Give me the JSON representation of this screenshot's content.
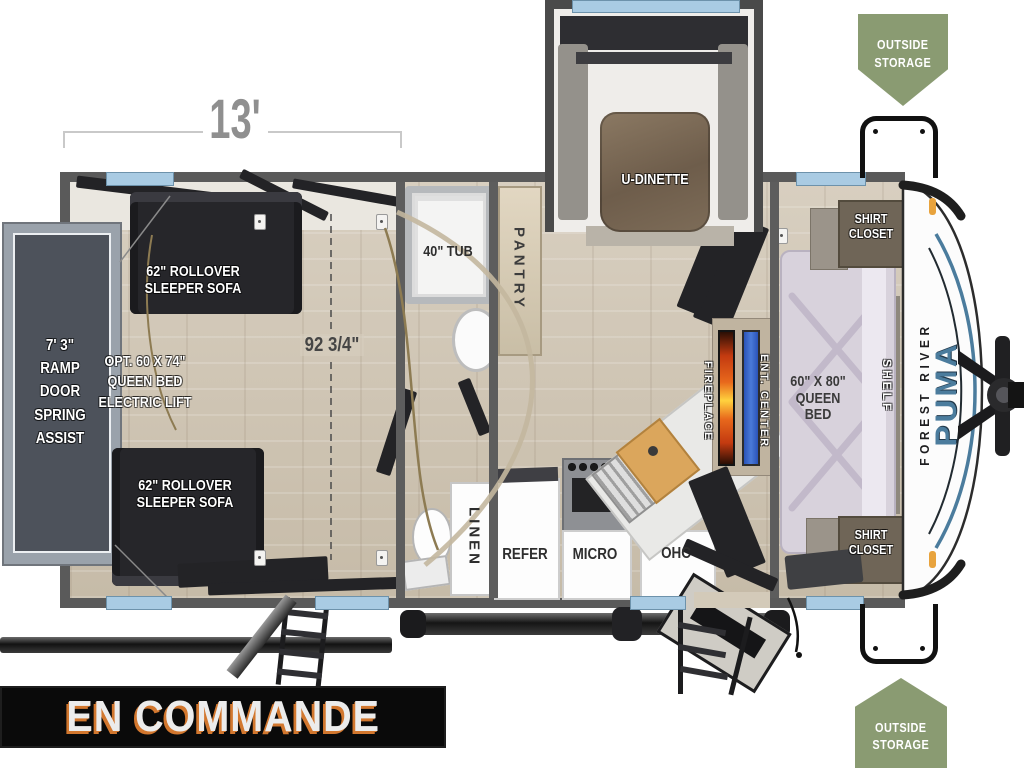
{
  "banner": "EN COMMANDE",
  "badge_top": [
    "OUTSIDE",
    "STORAGE"
  ],
  "badge_bottom": [
    "OUTSIDE",
    "STORAGE"
  ],
  "dims": {
    "length": "13'",
    "width": "92 3/4\""
  },
  "logo": {
    "brand": "FOREST RIVER",
    "model": "PUMA"
  },
  "labels": {
    "ramp": [
      "7' 3\"",
      "RAMP DOOR",
      "SPRING",
      "ASSIST"
    ],
    "sofa_top": [
      "62\" ROLLOVER",
      "SLEEPER SOFA"
    ],
    "sofa_bottom": [
      "62\" ROLLOVER",
      "SLEEPER SOFA"
    ],
    "opt_bed": [
      "OPT. 60 X 74\"",
      "QUEEN BED",
      "ELECTRIC LIFT"
    ],
    "tub": "40\" TUB",
    "pantry": "PANTRY",
    "dinette": "U-DINETTE",
    "linen": "LINEN",
    "refer": "REFER",
    "micro": "MICRO",
    "ohc": "OHC",
    "fireplace": "FIREPLACE",
    "ent_center": "ENT. CENTER",
    "queen_bed": [
      "60\" X 80\"",
      "QUEEN BED"
    ],
    "shirt_closet_top": [
      "SHIRT",
      "CLOSET"
    ],
    "shirt_closet_bottom": [
      "SHIRT",
      "CLOSET"
    ],
    "shelf": "SHELF"
  },
  "colors": {
    "badge_green": "#8a9b72",
    "window_blue": "#a9cbe3",
    "banner_bg": "#0a0a0a",
    "banner_text": "#ececec",
    "banner_shadow_orange": "#d2772e",
    "logo_blue": "#4b7c9d",
    "fireplace_flame": "#e8681c",
    "tv_blue": "#3a63c8",
    "wall_gray": "#5a5a5a",
    "floor_tan": "#cdc3b0",
    "ramp_gray": "#4d525b"
  }
}
